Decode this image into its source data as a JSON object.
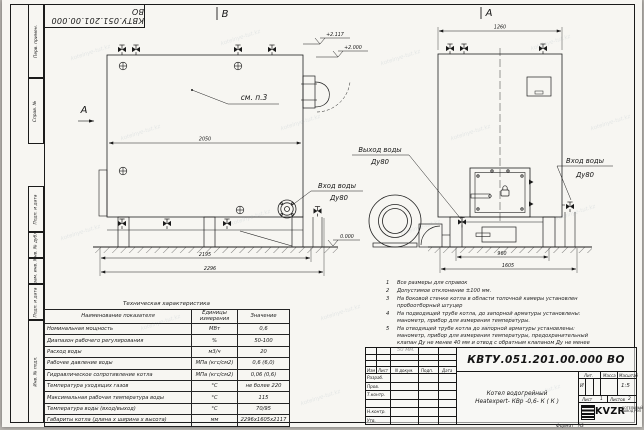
{
  "watermark": {
    "text": "kotelnye-tut.kz"
  },
  "corner_stamp": {
    "designation": "КВТУ.051.201.00.000 ВО"
  },
  "views": {
    "front_label": "А",
    "side_label": "В",
    "section_arrow_label": "А",
    "see_note": "см. п.3"
  },
  "dims": {
    "boiler_length": "2050",
    "base_length": "2195",
    "overall_length": "2296",
    "front_width": "1260",
    "base_width": "960",
    "overall_width": "1605"
  },
  "elevations": {
    "top": "+2.117",
    "mid": "+2.000",
    "ground": "0.000"
  },
  "pipe_labels": {
    "outlet_title": "Выход воды",
    "outlet_size": "Ду80",
    "inlet_side_title": "Вход воды",
    "inlet_side_size": "Ду80",
    "inlet_front_title": "Вход воды",
    "inlet_front_size": "Ду80"
  },
  "notes": {
    "items": [
      {
        "n": "1",
        "text": "Все размеры для справок"
      },
      {
        "n": "2",
        "text": "Допустимое отклонение ±100 мм."
      },
      {
        "n": "3",
        "text": "На боковой стенке котла в области топочной камеры установлен пробоотборный штуцер"
      },
      {
        "n": "4",
        "text": "На подводящей трубе котла, до запорной арматуры установлены: манометр, прибор для измерения температуры."
      },
      {
        "n": "5",
        "text": "На отводящей трубе котла до запорной арматуры установлены: манометр, прибор для измерения температуры, предохранительный клапан Ду не менее 40 мм и отвод с обратным клапаном Ду не менее 50 мм."
      }
    ]
  },
  "spec_table": {
    "title": "Техническая характеристика",
    "headers": [
      "Наименование показателя",
      "Единицы измерения",
      "Значение"
    ],
    "rows": [
      [
        "Номинальная мощность",
        "МВт",
        "0,6"
      ],
      [
        "Диапазон рабочего регулирования",
        "%",
        "50-100"
      ],
      [
        "Расход воды",
        "м3/ч",
        "20"
      ],
      [
        "Рабочее давление воды",
        "МПа (кгс/см2)",
        "0,6 (6,0)"
      ],
      [
        "Гидравлическое сопротивление котла",
        "МПа (кгс/см2)",
        "0,06 (0,6)"
      ],
      [
        "Температура уходящих газов",
        "°С",
        "не более 220"
      ],
      [
        "Максимальная рабочая температура воды",
        "°С",
        "115"
      ],
      [
        "Температура воды (вход/выход)",
        "°С",
        "70/95"
      ],
      [
        "Габариты котла (длина х ширина х высота)",
        "мм",
        "2296х1605х2117"
      ]
    ]
  },
  "title_block": {
    "designation": "КВТУ.051.201.00.000 ВО",
    "product_line1": "Котел водогрейный",
    "product_line2": "Heatexpert- КВр -0,6- К ( К )",
    "cols": [
      "Изм",
      "Лист",
      "N докум.",
      "Подп.",
      "Дата"
    ],
    "rows": [
      "Разраб.",
      "Пров.",
      "Т.контр.",
      "",
      "Н.контр.",
      "Утв."
    ],
    "lit_header": "Лит.",
    "mass_header": "Масса",
    "scale_header": "Масштаб",
    "lit_value": "И",
    "mass_value": "",
    "scale_value": "1:5",
    "sheet_label": "Лист",
    "sheet_value": "1",
    "sheets_label": "Листов",
    "sheets_value": "2",
    "logo_mark": "KVZR",
    "logo_sub1": "КОТЕЛЬНЫЙ",
    "logo_sub2": "ЗАВОД РЭП",
    "format_label": "Формат",
    "format_value": "А3"
  },
  "frame": {
    "side_labels": [
      "Перв. примен.",
      "Справ. №",
      "Подп. и дата",
      "Инв. № дубл.",
      "Взам. инв. №",
      "Подп. и дата",
      "Инв. № подл."
    ]
  }
}
